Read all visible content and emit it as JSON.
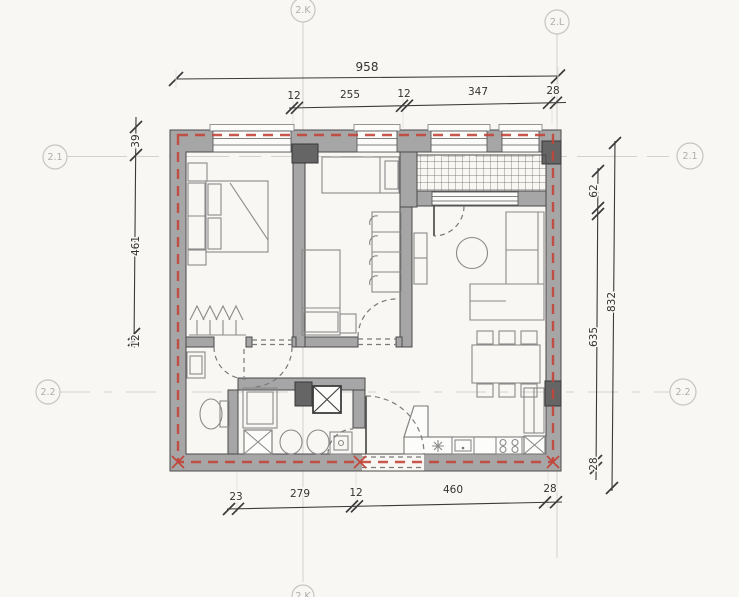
{
  "axis_markers": {
    "top_k": "2.K",
    "top_l": "2.L",
    "left_1": "2.1",
    "left_2": "2.2",
    "right_1": "2.1",
    "right_2": "2.2",
    "bottom_k": "2.K"
  },
  "dimensions": {
    "total_width": "958",
    "top_segments": [
      "12",
      "255",
      "12",
      "347",
      "28"
    ],
    "left_segments": [
      "39",
      "461",
      "12"
    ],
    "right_total": "832",
    "right_segments": [
      "62",
      "635",
      "28"
    ],
    "bottom_segments": [
      "23",
      "279",
      "12",
      "460",
      "28"
    ]
  },
  "colors": {
    "wall": "#a6a6a6",
    "column": "#656565",
    "insulation_dashed": "#c2453a",
    "axis_gray": "#c6c5c1",
    "dimension_text": "#333333",
    "background": "#f8f7f4"
  }
}
